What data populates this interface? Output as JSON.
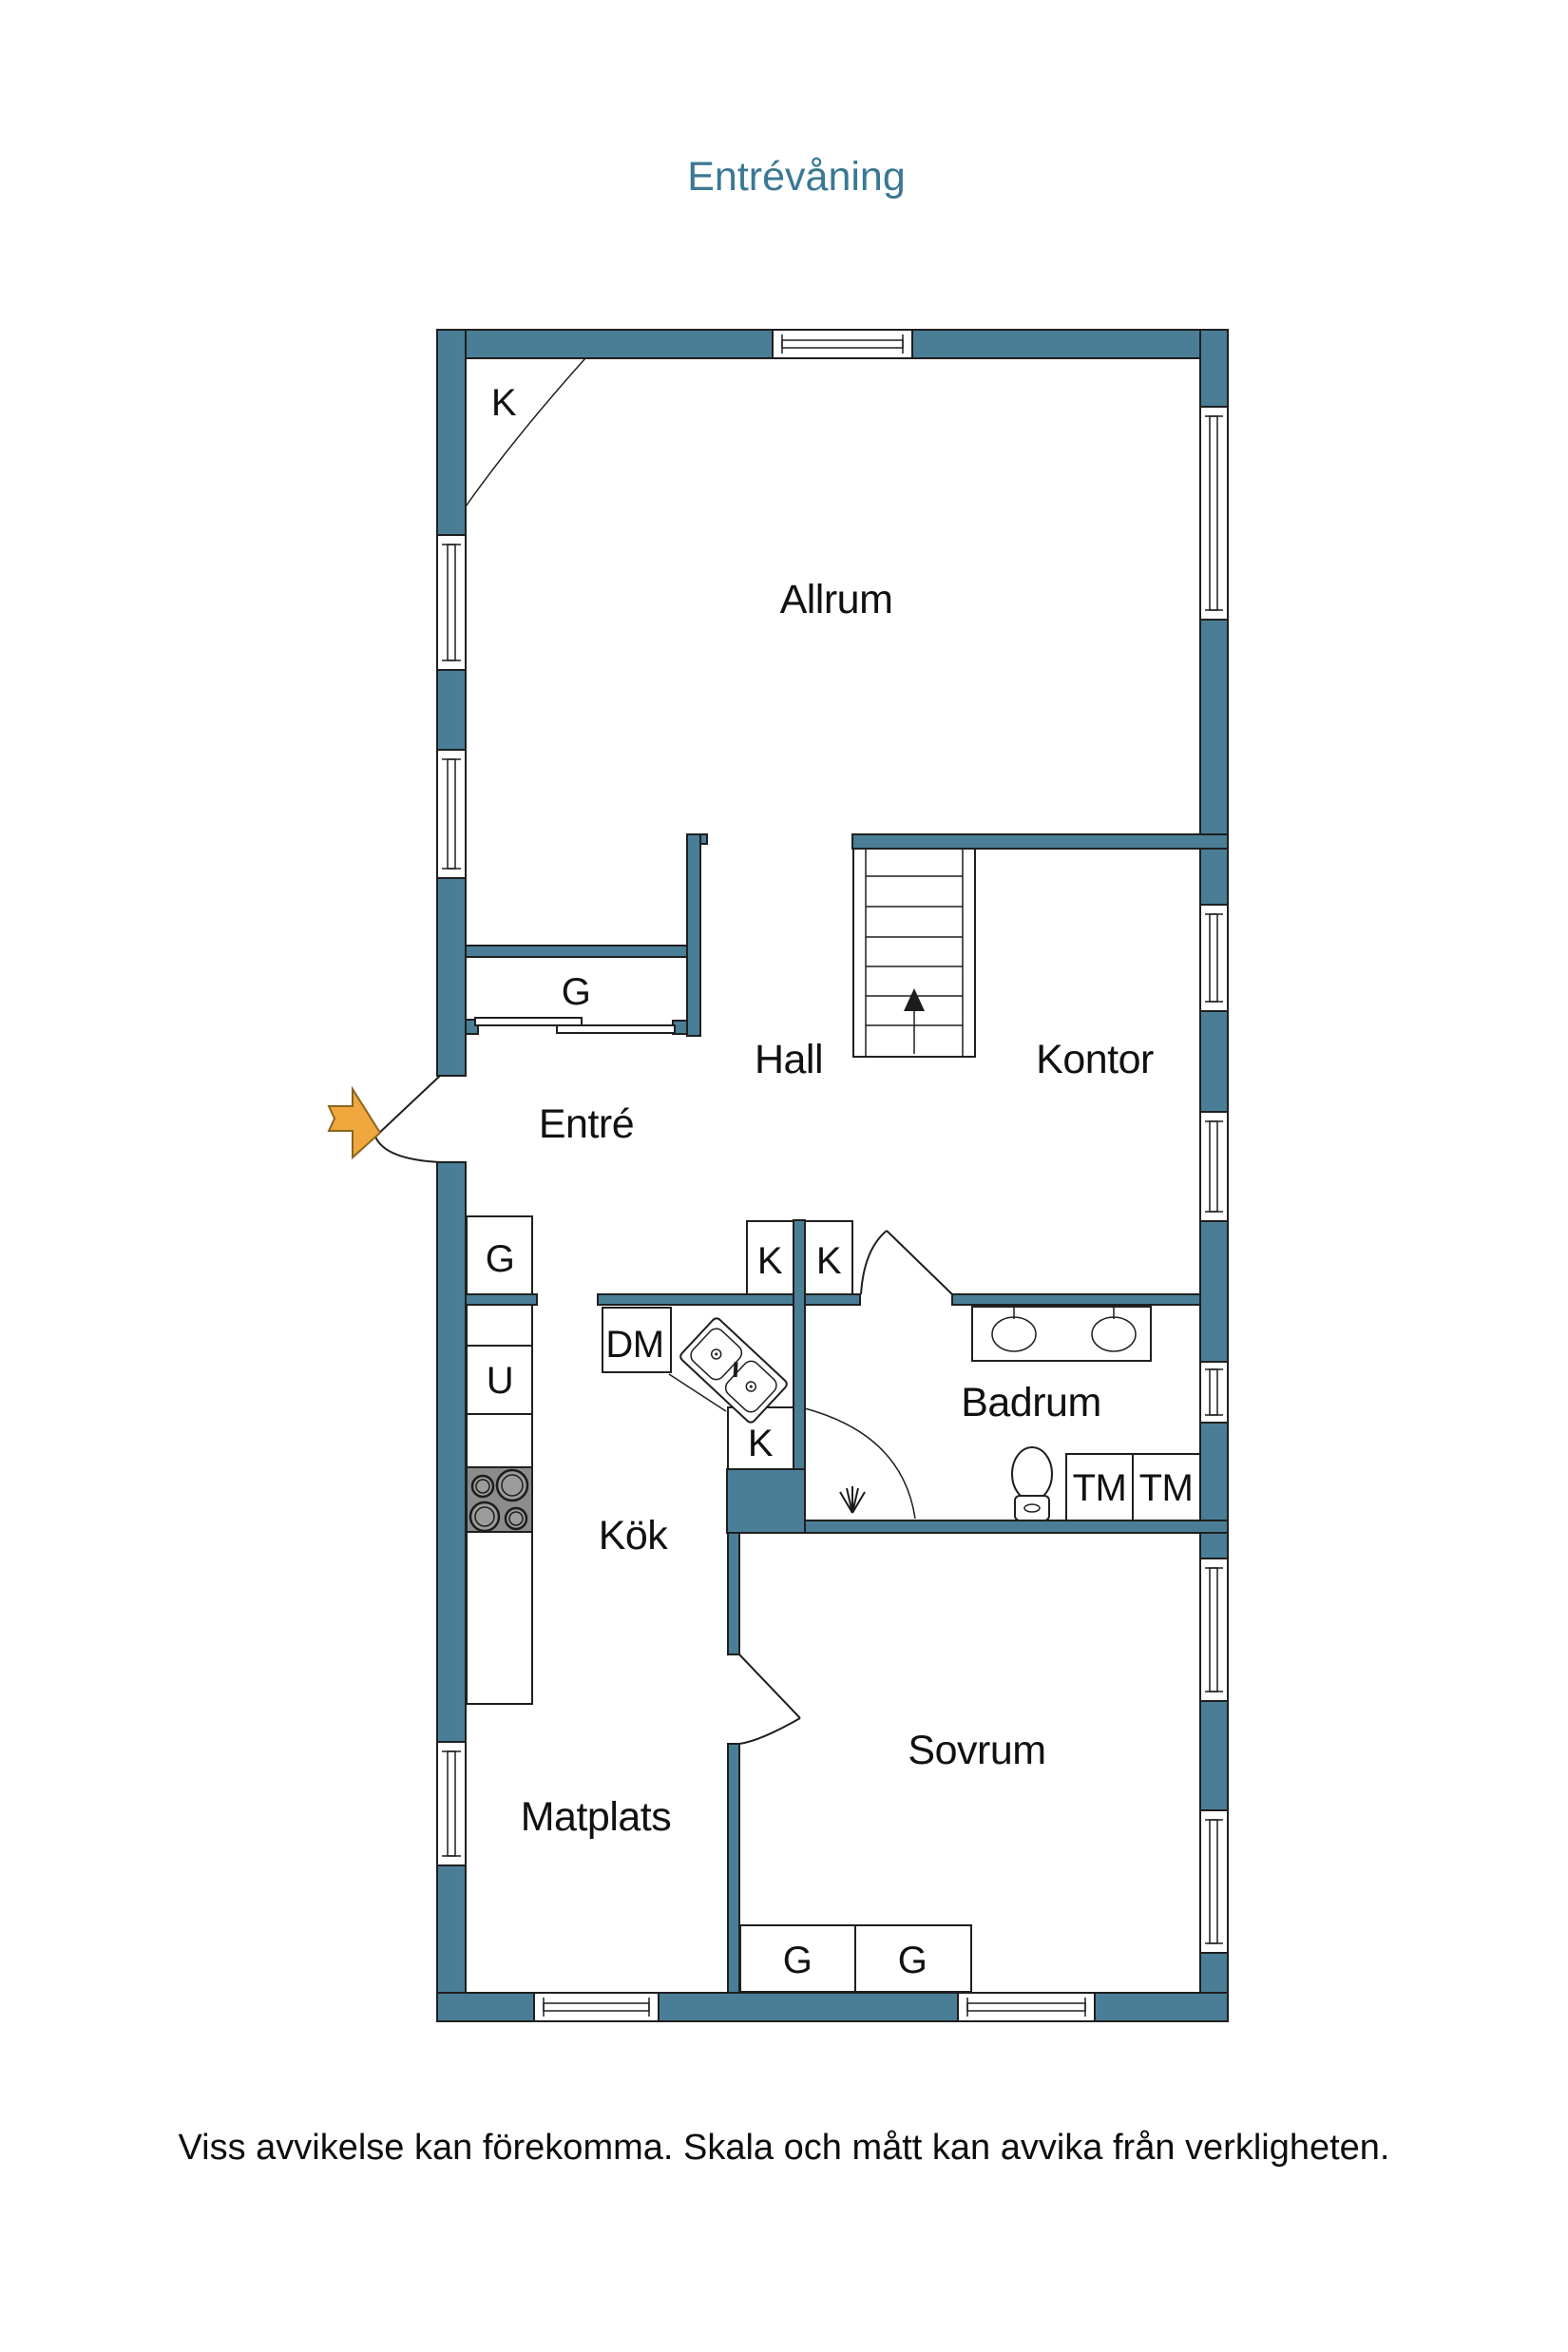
{
  "title": "Entrévåning",
  "disclaimer": "Viss avvikelse kan förekomma. Skala och mått kan avvika från verkligheten.",
  "colors": {
    "wall": "#4A7E96",
    "outline": "#1f1f1f",
    "title": "#3A7894",
    "arrow": "#F0A73D",
    "stove": "#8c8c8c"
  },
  "rooms": {
    "allrum": "Allrum",
    "hall": "Hall",
    "kontor": "Kontor",
    "entre": "Entré",
    "kok": "Kök",
    "matplats": "Matplats",
    "badrum": "Badrum",
    "sovrum": "Sovrum"
  },
  "labels": {
    "k": "K",
    "g": "G",
    "dm": "DM",
    "u": "U",
    "tm": "TM"
  }
}
